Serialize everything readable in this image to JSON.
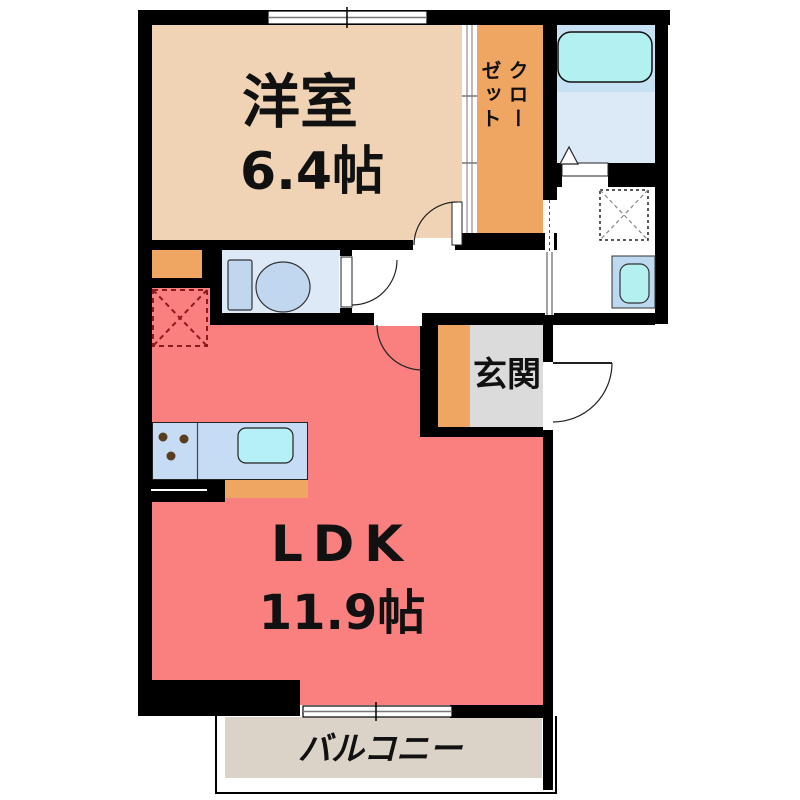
{
  "plan_title": "1LDK floor plan",
  "rooms": {
    "bedroom": {
      "label": "洋室",
      "size": "6.4帖",
      "color": "#F0D3B4"
    },
    "closet": {
      "label": "クローゼット",
      "label_lines": [
        "クロー",
        "ゼット"
      ],
      "color": "#F0A663"
    },
    "ldk": {
      "label": "LDK",
      "size": "11.9帖",
      "color": "#FA8080"
    },
    "entrance": {
      "label": "玄関",
      "color": "#DBDBDB",
      "step_color": "#F0A663"
    },
    "balcony": {
      "label": "バルコニー",
      "color": "#DBD3C7"
    },
    "toilet_room": {
      "color": "#DDE9F6"
    },
    "bathroom": {
      "tub_zone_color": "#C6E0F4",
      "floor_color": "#DCEAF8"
    },
    "washroom": {
      "color": "#FFFFFF"
    },
    "hallway": {
      "color": "#FFFFFF"
    }
  },
  "fixtures": {
    "bathtub": {
      "color": "#B2F0F1"
    },
    "toilet": {
      "color": "#C1D7F0"
    },
    "kitchen_counter": {
      "color": "#C6DCF4"
    },
    "kitchen_sink": {
      "color": "#B4F0F5"
    },
    "kitchen_base": {
      "color": "#F0A663"
    },
    "washroom_sink": {
      "panel_color": "#BDD9F0",
      "basin_color": "#B4F0F0"
    },
    "stove_burner_color": "#5A3C1E",
    "refrigerator_space_color": "#8B1A1A",
    "wall_color": "#000000"
  }
}
